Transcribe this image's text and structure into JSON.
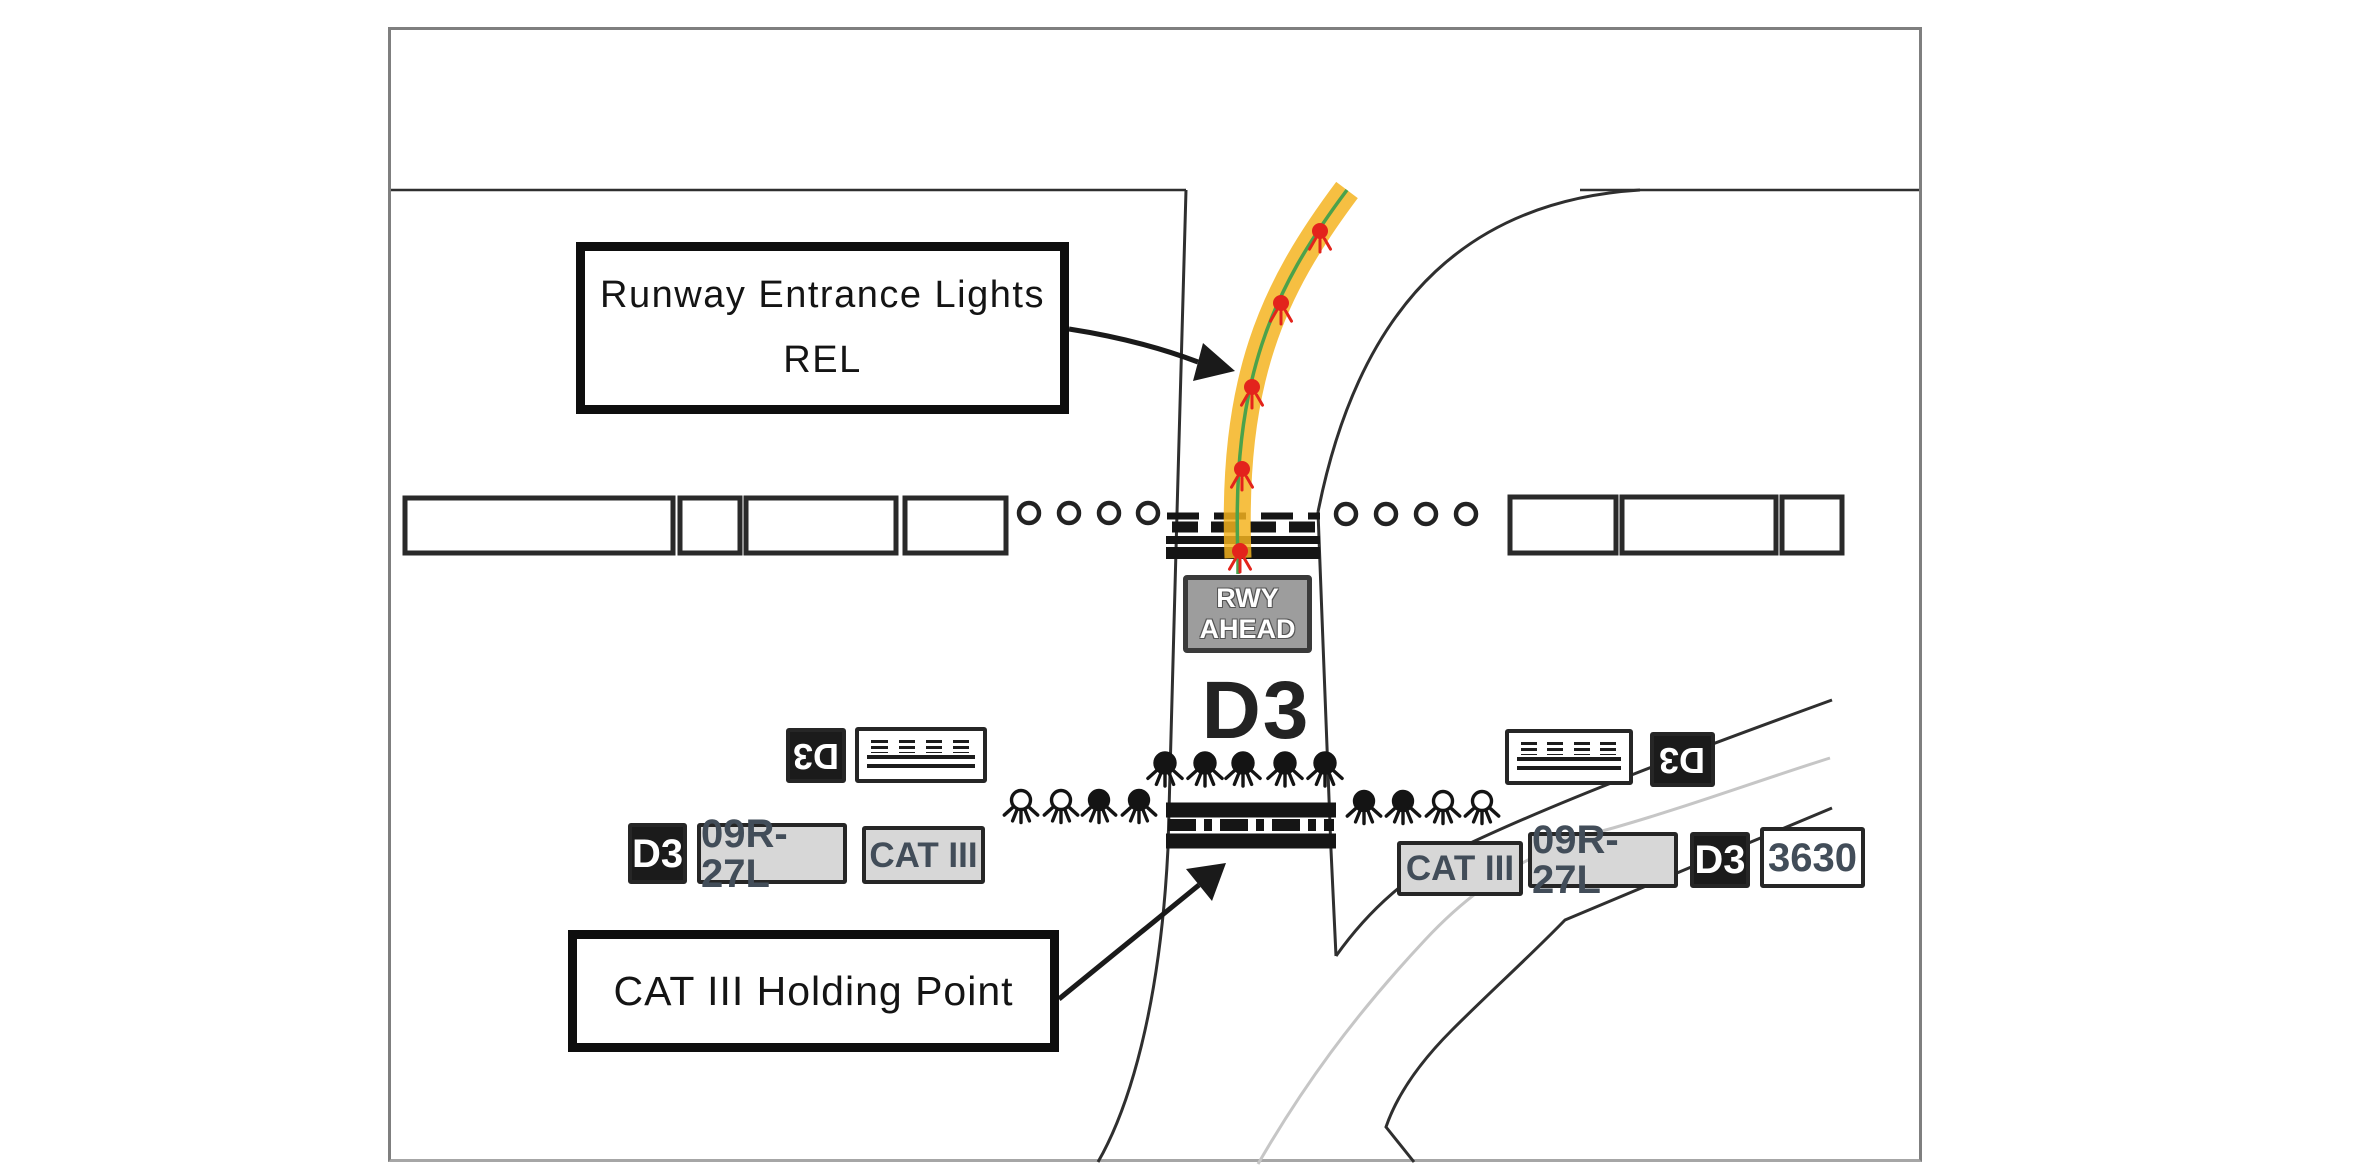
{
  "labels": {
    "rel_line1": "Runway Entrance Lights",
    "rel_line2": "REL",
    "cat3": "CAT III Holding Point"
  },
  "signs": {
    "rwy_ahead_line1": "RWY",
    "rwy_ahead_line2": "AHEAD",
    "taxiway_big": "D3",
    "left_upper_d3_rev": "D3",
    "right_upper_d3_rev": "D3",
    "left_d3": "D3",
    "left_runway": "09R-27L",
    "left_cat": "CAT III",
    "right_cat": "CAT III",
    "right_runway": "09R-27L",
    "right_d3": "D3",
    "right_stand": "3630"
  },
  "colors": {
    "frame_border": "#7f7f7f",
    "line_dark": "#2f2f2f",
    "line_gray": "#c6c6c6",
    "marking_black": "#151515",
    "taxiway_yellow": "#f4b31e",
    "centerline_green": "#4ba24b",
    "rel_red": "#e3231c",
    "sign_gray_bg": "#d7d7d7",
    "sign_dark_bg": "#1b1b1b",
    "sign_text_dark": "#424d59",
    "rwy_sign_bg": "#9d9d9d",
    "rwy_sign_border": "#3a3a3a",
    "label_border": "#0e0e0e",
    "bar_stroke": "#2a2a2a"
  },
  "lights": {
    "rel_dots": [
      [
        1320,
        231
      ],
      [
        1281,
        303
      ],
      [
        1252,
        387
      ],
      [
        1242,
        469
      ],
      [
        1240,
        551
      ]
    ],
    "stopbar_row": {
      "y": 763,
      "x": [
        1165,
        1205,
        1243,
        1285,
        1325
      ]
    },
    "guard_left": {
      "y": 800,
      "items": [
        {
          "x": 1021,
          "filled": false
        },
        {
          "x": 1061,
          "filled": false
        },
        {
          "x": 1099,
          "filled": true
        },
        {
          "x": 1139,
          "filled": true
        }
      ]
    },
    "guard_right": {
      "y": 801,
      "items": [
        {
          "x": 1364,
          "filled": true
        },
        {
          "x": 1403,
          "filled": true
        },
        {
          "x": 1443,
          "filled": false
        },
        {
          "x": 1482,
          "filled": false
        }
      ]
    },
    "edge_circles_left": {
      "y": 513,
      "x": [
        1029,
        1069,
        1109,
        1148
      ]
    },
    "edge_circles_right": {
      "y": 514,
      "x": [
        1346,
        1386,
        1426,
        1466
      ]
    }
  }
}
